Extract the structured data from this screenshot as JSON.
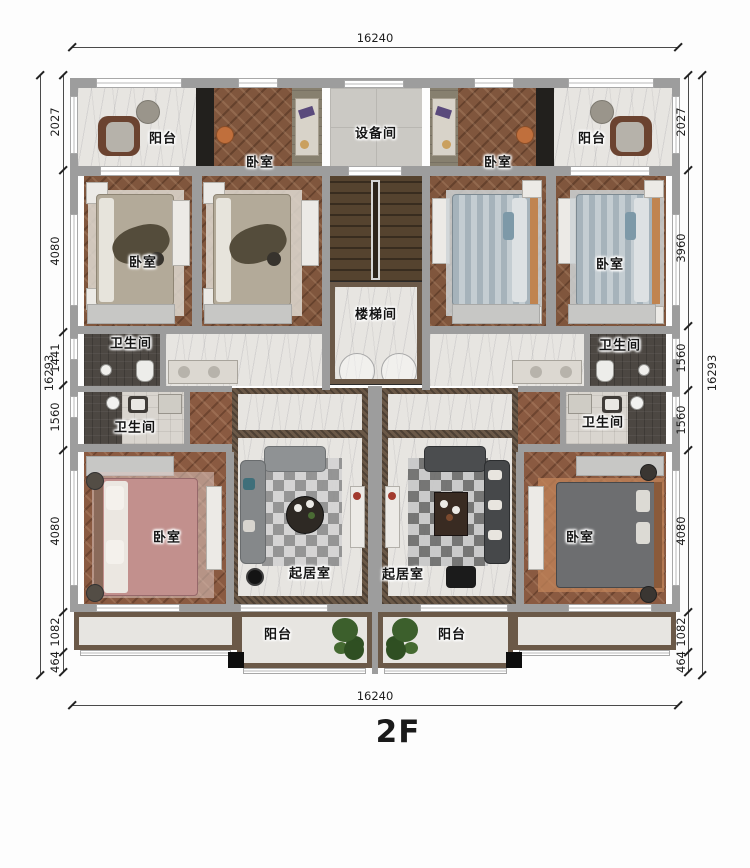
{
  "floor_label": "2F",
  "rooms": {
    "balcony_top_left": "阳台",
    "bedroom_top_left": "卧室",
    "equipment_room": "设备间",
    "bedroom_top_right": "卧室",
    "balcony_top_right": "阳台",
    "bedroom_mid_left": "卧室",
    "bedroom_mid_right": "卧室",
    "stairwell": "楼梯间",
    "bathroom_upper_left": "卫生间",
    "bathroom_upper_right": "卫生间",
    "bathroom_lower_left": "卫生间",
    "bathroom_lower_right": "卫生间",
    "bedroom_lower_left": "卧室",
    "living_room_left": "起居室",
    "living_room_right": "起居室",
    "bedroom_lower_right": "卧室",
    "balcony_bottom_left": "阳台",
    "balcony_bottom_right": "阳台"
  },
  "dimensions": {
    "top": "16240",
    "bottom": "16240",
    "left_total": "16293",
    "right_total": "16293",
    "left_chain": [
      "2027",
      "4080",
      "1441",
      "1560",
      "4080",
      "1082",
      "464"
    ],
    "right_chain": [
      "2027",
      "3960",
      "1560",
      "1560",
      "4080",
      "1082",
      "464"
    ]
  },
  "colors": {
    "wall": "#9d9d9d",
    "wood_floor": "#80563d",
    "marble_floor": "#e7e5e1",
    "dark_trim": "#6b5948",
    "wet_floor": "#4c4742",
    "plant": "#3c5f2c"
  }
}
